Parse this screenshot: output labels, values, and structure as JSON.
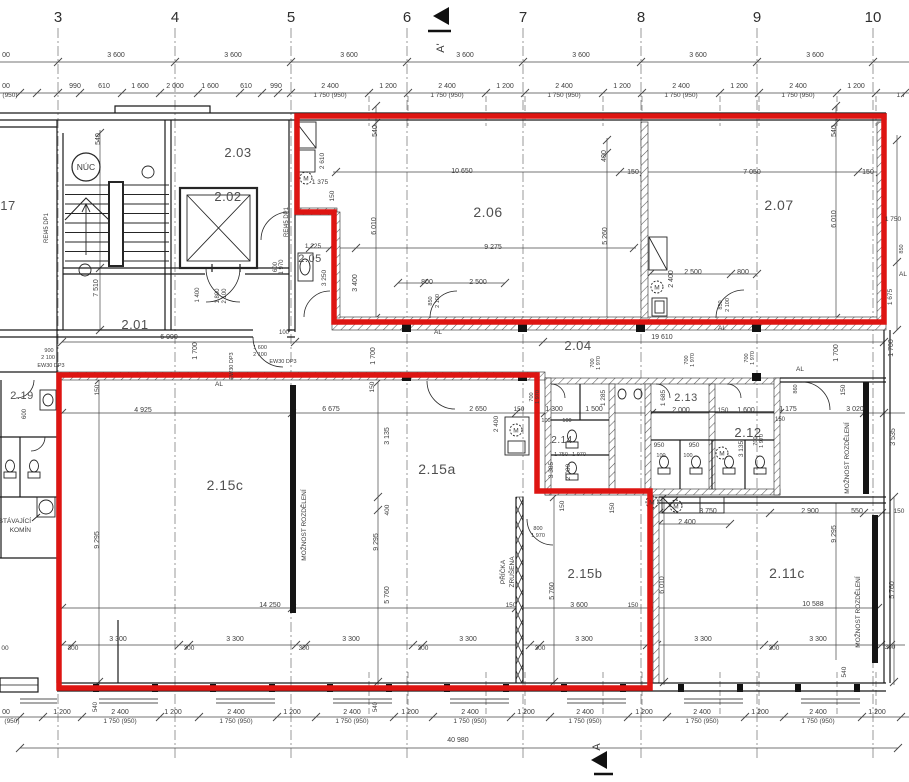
{
  "drawing": {
    "type": "floor-plan",
    "background": "#ffffff"
  },
  "colors": {
    "highlight_red": "#de1512",
    "ink": "#1b1b1b",
    "dim_text": "#3d3d3d"
  },
  "grid_numbers": [
    {
      "t": "3",
      "x": 58
    },
    {
      "t": "4",
      "x": 175
    },
    {
      "t": "5",
      "x": 291
    },
    {
      "t": "6",
      "x": 407
    },
    {
      "t": "7",
      "x": 523
    },
    {
      "t": "8",
      "x": 641
    },
    {
      "t": "9",
      "x": 757
    },
    {
      "t": "10",
      "x": 873
    }
  ],
  "section_markers": {
    "top": "A'",
    "bottom": "A"
  },
  "rooms": [
    {
      "t": "17",
      "x": 8,
      "y": 210,
      "s": 13
    },
    {
      "t": "2.01",
      "x": 135,
      "y": 329,
      "s": 13
    },
    {
      "t": "2.02",
      "x": 228,
      "y": 201,
      "s": 13
    },
    {
      "t": "2.03",
      "x": 238,
      "y": 157,
      "s": 13
    },
    {
      "t": "2.04",
      "x": 578,
      "y": 350,
      "s": 13
    },
    {
      "t": "2.05",
      "x": 310,
      "y": 262,
      "s": 11
    },
    {
      "t": "2.06",
      "x": 488,
      "y": 217,
      "s": 14
    },
    {
      "t": "2.07",
      "x": 779,
      "y": 210,
      "s": 14
    },
    {
      "t": "2.11c",
      "x": 787,
      "y": 578,
      "s": 14
    },
    {
      "t": "2.12",
      "x": 748,
      "y": 437,
      "s": 13
    },
    {
      "t": "2.13",
      "x": 686,
      "y": 401,
      "s": 11
    },
    {
      "t": "2.14",
      "x": 562,
      "y": 443,
      "s": 10
    },
    {
      "t": "2.15a",
      "x": 437,
      "y": 474,
      "s": 14
    },
    {
      "t": "2.15b",
      "x": 585,
      "y": 578,
      "s": 13
    },
    {
      "t": "2.15c",
      "x": 225,
      "y": 490,
      "s": 14
    },
    {
      "t": "2.19",
      "x": 22,
      "y": 399,
      "s": 11
    }
  ],
  "special_labels": {
    "nuc": {
      "t": "NÚC",
      "x": 86,
      "y": 167,
      "radius": 14
    },
    "motor_letter": "M",
    "motors": [
      {
        "x": 306,
        "y": 178
      },
      {
        "x": 657,
        "y": 287
      },
      {
        "x": 516,
        "y": 430
      },
      {
        "x": 652,
        "y": 502
      },
      {
        "x": 722,
        "y": 453
      },
      {
        "x": 676,
        "y": 506
      }
    ]
  },
  "annotations": [
    {
      "t": "STÁVAJÍCÍ",
      "x": 31,
      "y": 523,
      "s": 6.5,
      "a": "e"
    },
    {
      "t": "KOMÍN",
      "x": 31,
      "y": 532,
      "s": 6.5,
      "a": "e"
    },
    {
      "t": "MOŽNOST ROZDĚLENÍ",
      "x": 306,
      "y": 525,
      "r": 1,
      "s": 6.5
    },
    {
      "t": "MOŽNOST ROZDĚLENÍ",
      "x": 849,
      "y": 458,
      "r": 1,
      "s": 6.5
    },
    {
      "t": "MOŽNOST ROZDĚLENÍ",
      "x": 860,
      "y": 612,
      "r": 1,
      "s": 6.5
    },
    {
      "t": "PŘÍČKA",
      "x": 505,
      "y": 572,
      "r": 1,
      "s": 6.5
    },
    {
      "t": "ZRUŠENA",
      "x": 514,
      "y": 572,
      "r": 1,
      "s": 6.5
    },
    {
      "t": "AL",
      "x": 219,
      "y": 386,
      "s": 6.5
    },
    {
      "t": "AL",
      "x": 438,
      "y": 334,
      "s": 6.5
    },
    {
      "t": "AL",
      "x": 722,
      "y": 330,
      "s": 6.5
    },
    {
      "t": "AL",
      "x": 800,
      "y": 371,
      "s": 6.5
    },
    {
      "t": "AL",
      "x": 903,
      "y": 276,
      "s": 6.5
    },
    {
      "t": "EW30 DP3",
      "x": 51,
      "y": 367,
      "s": 5.5
    },
    {
      "t": "EW30 DP3",
      "x": 283,
      "y": 363,
      "s": 5.5
    },
    {
      "t": "EW30 DP3",
      "x": 233,
      "y": 366,
      "r": 1,
      "s": 5.5
    },
    {
      "t": "REI45 DP1",
      "x": 48,
      "y": 228,
      "r": 1,
      "s": 6
    },
    {
      "t": "REI45 DP1",
      "x": 288,
      "y": 222,
      "r": 1,
      "s": 6
    }
  ],
  "dimensions": [
    {
      "t": "00",
      "x": 6,
      "y": 57
    },
    {
      "t": "3 600",
      "x": 116,
      "y": 57
    },
    {
      "t": "3 600",
      "x": 233,
      "y": 57
    },
    {
      "t": "3 600",
      "x": 349,
      "y": 57
    },
    {
      "t": "3 600",
      "x": 465,
      "y": 57
    },
    {
      "t": "3 600",
      "x": 581,
      "y": 57
    },
    {
      "t": "3 600",
      "x": 698,
      "y": 57
    },
    {
      "t": "3 600",
      "x": 815,
      "y": 57
    },
    {
      "t": "00",
      "x": 6,
      "y": 88
    },
    {
      "t": "(950)",
      "x": 10,
      "y": 97,
      "s": 6.5
    },
    {
      "t": "990",
      "x": 75,
      "y": 88
    },
    {
      "t": "610",
      "x": 104,
      "y": 88
    },
    {
      "t": "1 600",
      "x": 140,
      "y": 88
    },
    {
      "t": "2 000",
      "x": 175,
      "y": 88
    },
    {
      "t": "1 600",
      "x": 210,
      "y": 88
    },
    {
      "t": "610",
      "x": 246,
      "y": 88
    },
    {
      "t": "990",
      "x": 276,
      "y": 88
    },
    {
      "t": "2 400",
      "x": 330,
      "y": 88
    },
    {
      "t": "1 750 (950)",
      "x": 330,
      "y": 97,
      "s": 6.5
    },
    {
      "t": "1 200",
      "x": 388,
      "y": 88
    },
    {
      "t": "2 400",
      "x": 447,
      "y": 88
    },
    {
      "t": "1 750 (950)",
      "x": 447,
      "y": 97,
      "s": 6.5
    },
    {
      "t": "1 200",
      "x": 505,
      "y": 88
    },
    {
      "t": "2 400",
      "x": 564,
      "y": 88
    },
    {
      "t": "1 750 (950)",
      "x": 564,
      "y": 97,
      "s": 6.5
    },
    {
      "t": "1 200",
      "x": 622,
      "y": 88
    },
    {
      "t": "2 400",
      "x": 681,
      "y": 88
    },
    {
      "t": "1 750 (950)",
      "x": 681,
      "y": 97,
      "s": 6.5
    },
    {
      "t": "1 200",
      "x": 739,
      "y": 88
    },
    {
      "t": "2 400",
      "x": 798,
      "y": 88
    },
    {
      "t": "1 750 (950)",
      "x": 798,
      "y": 97,
      "s": 6.5
    },
    {
      "t": "1 200",
      "x": 856,
      "y": 88
    },
    {
      "t": "1 7",
      "x": 901,
      "y": 97,
      "s": 6.5
    },
    {
      "t": "00",
      "x": 6,
      "y": 714
    },
    {
      "t": "(950)",
      "x": 12,
      "y": 723,
      "s": 6.5
    },
    {
      "t": "1 200",
      "x": 62,
      "y": 714
    },
    {
      "t": "540",
      "x": 97,
      "y": 707,
      "r": 1,
      "s": 6
    },
    {
      "t": "2 400",
      "x": 120,
      "y": 714
    },
    {
      "t": "1 750 (950)",
      "x": 120,
      "y": 723,
      "s": 6.5
    },
    {
      "t": "1 200",
      "x": 173,
      "y": 714
    },
    {
      "t": "2 400",
      "x": 236,
      "y": 714
    },
    {
      "t": "1 750 (950)",
      "x": 236,
      "y": 723,
      "s": 6.5
    },
    {
      "t": "1 200",
      "x": 292,
      "y": 714
    },
    {
      "t": "2 400",
      "x": 352,
      "y": 714
    },
    {
      "t": "1 750 (950)",
      "x": 352,
      "y": 723,
      "s": 6.5
    },
    {
      "t": "540",
      "x": 377,
      "y": 707,
      "r": 1,
      "s": 6
    },
    {
      "t": "1 200",
      "x": 410,
      "y": 714
    },
    {
      "t": "2 400",
      "x": 470,
      "y": 714
    },
    {
      "t": "1 750 (950)",
      "x": 470,
      "y": 723,
      "s": 6.5
    },
    {
      "t": "1 200",
      "x": 526,
      "y": 714
    },
    {
      "t": "2 400",
      "x": 585,
      "y": 714
    },
    {
      "t": "1 750 (950)",
      "x": 585,
      "y": 723,
      "s": 6.5
    },
    {
      "t": "1 200",
      "x": 644,
      "y": 714
    },
    {
      "t": "2 400",
      "x": 702,
      "y": 714
    },
    {
      "t": "1 750 (950)",
      "x": 702,
      "y": 723,
      "s": 6.5
    },
    {
      "t": "1 200",
      "x": 760,
      "y": 714
    },
    {
      "t": "2 400",
      "x": 818,
      "y": 714
    },
    {
      "t": "1 750 (950)",
      "x": 818,
      "y": 723,
      "s": 6.5
    },
    {
      "t": "1 200",
      "x": 877,
      "y": 714
    },
    {
      "t": "40 980",
      "x": 458,
      "y": 742
    },
    {
      "t": "540",
      "x": 100,
      "y": 139,
      "r": 1,
      "s": 7
    },
    {
      "t": "7 510",
      "x": 98,
      "y": 288,
      "r": 1
    },
    {
      "t": "1 400",
      "x": 199,
      "y": 295,
      "r": 1,
      "s": 6
    },
    {
      "t": "1 800",
      "x": 219,
      "y": 296,
      "r": 1,
      "s": 6
    },
    {
      "t": "2 100",
      "x": 226,
      "y": 296,
      "r": 1,
      "s": 6
    },
    {
      "t": "600",
      "x": 277,
      "y": 267,
      "r": 1,
      "s": 6
    },
    {
      "t": "1 970",
      "x": 283,
      "y": 267,
      "r": 1,
      "s": 6
    },
    {
      "t": "6 990",
      "x": 169,
      "y": 339
    },
    {
      "t": "100",
      "x": 284,
      "y": 334,
      "s": 6
    },
    {
      "t": "900",
      "x": 49,
      "y": 352,
      "s": 5.5
    },
    {
      "t": "2 100",
      "x": 48,
      "y": 359,
      "s": 5.5
    },
    {
      "t": "1 600",
      "x": 260,
      "y": 349,
      "s": 5.5
    },
    {
      "t": "2 100",
      "x": 260,
      "y": 356,
      "s": 5.5
    },
    {
      "t": "600",
      "x": 26,
      "y": 414,
      "r": 1,
      "s": 6
    },
    {
      "t": "2 610",
      "x": 324,
      "y": 161,
      "r": 1,
      "s": 6.5
    },
    {
      "t": "1 375",
      "x": 320,
      "y": 184,
      "s": 6.5
    },
    {
      "t": "150",
      "x": 334,
      "y": 196,
      "r": 1,
      "s": 6.5
    },
    {
      "t": "1 225",
      "x": 313,
      "y": 248,
      "s": 6.5
    },
    {
      "t": "3 250",
      "x": 326,
      "y": 278,
      "r": 1,
      "s": 6.5
    },
    {
      "t": "3 400",
      "x": 357,
      "y": 283,
      "r": 1
    },
    {
      "t": "540",
      "x": 377,
      "y": 131,
      "r": 1,
      "s": 7
    },
    {
      "t": "6 010",
      "x": 376,
      "y": 226,
      "r": 1
    },
    {
      "t": "10 650",
      "x": 462,
      "y": 173
    },
    {
      "t": "9 275",
      "x": 493,
      "y": 249
    },
    {
      "t": "800",
      "x": 427,
      "y": 284,
      "s": 7
    },
    {
      "t": "2 500",
      "x": 478,
      "y": 284
    },
    {
      "t": "850",
      "x": 432,
      "y": 301,
      "r": 1,
      "s": 5.5
    },
    {
      "t": "2 100",
      "x": 439,
      "y": 301,
      "r": 1,
      "s": 5.5
    },
    {
      "t": "400",
      "x": 606,
      "y": 156,
      "r": 1,
      "s": 7
    },
    {
      "t": "5 260",
      "x": 607,
      "y": 236,
      "r": 1
    },
    {
      "t": "150",
      "x": 633,
      "y": 174,
      "s": 7
    },
    {
      "t": "7 050",
      "x": 752,
      "y": 174
    },
    {
      "t": "150",
      "x": 868,
      "y": 174,
      "s": 7
    },
    {
      "t": "540",
      "x": 836,
      "y": 131,
      "r": 1,
      "s": 7
    },
    {
      "t": "6 010",
      "x": 836,
      "y": 219,
      "r": 1
    },
    {
      "t": "2 400",
      "x": 673,
      "y": 279,
      "r": 1
    },
    {
      "t": "2 500",
      "x": 693,
      "y": 274
    },
    {
      "t": "800",
      "x": 743,
      "y": 274,
      "s": 7
    },
    {
      "t": "850",
      "x": 722,
      "y": 305,
      "r": 1,
      "s": 5.5
    },
    {
      "t": "2 100",
      "x": 729,
      "y": 305,
      "r": 1,
      "s": 5.5
    },
    {
      "t": "1 750",
      "x": 893,
      "y": 221,
      "s": 6.5
    },
    {
      "t": "850",
      "x": 903,
      "y": 249,
      "r": 1,
      "s": 5.5
    },
    {
      "t": "1 675",
      "x": 892,
      "y": 297,
      "r": 1,
      "s": 6.5
    },
    {
      "t": "19 610",
      "x": 662,
      "y": 339
    },
    {
      "t": "1 700",
      "x": 197,
      "y": 351,
      "r": 1
    },
    {
      "t": "1 700",
      "x": 375,
      "y": 356,
      "r": 1
    },
    {
      "t": "1 700",
      "x": 838,
      "y": 353,
      "r": 1
    },
    {
      "t": "1 700",
      "x": 893,
      "y": 348,
      "r": 1
    },
    {
      "t": "150",
      "x": 99,
      "y": 390,
      "r": 1,
      "s": 6.5
    },
    {
      "t": "150",
      "x": 374,
      "y": 387,
      "r": 1,
      "s": 6.5
    },
    {
      "t": "150",
      "x": 845,
      "y": 390,
      "r": 1,
      "s": 6.5
    },
    {
      "t": "1 285",
      "x": 605,
      "y": 398,
      "r": 1,
      "s": 6.5
    },
    {
      "t": "1 300",
      "x": 554,
      "y": 411,
      "s": 7
    },
    {
      "t": "1 500",
      "x": 594,
      "y": 411,
      "s": 7
    },
    {
      "t": "100",
      "x": 546,
      "y": 422,
      "s": 5.5
    },
    {
      "t": "100",
      "x": 567,
      "y": 422,
      "s": 5.5
    },
    {
      "t": "700",
      "x": 533,
      "y": 397,
      "r": 1,
      "s": 5.5
    },
    {
      "t": "1 970",
      "x": 539,
      "y": 397,
      "r": 1,
      "s": 5.5
    },
    {
      "t": "700",
      "x": 594,
      "y": 363,
      "r": 1,
      "s": 5.5
    },
    {
      "t": "1 970",
      "x": 600,
      "y": 363,
      "r": 1,
      "s": 5.5
    },
    {
      "t": "700",
      "x": 688,
      "y": 360,
      "r": 1,
      "s": 5.5
    },
    {
      "t": "1 970",
      "x": 694,
      "y": 360,
      "r": 1,
      "s": 5.5
    },
    {
      "t": "700",
      "x": 748,
      "y": 358,
      "r": 1,
      "s": 5.5
    },
    {
      "t": "1 970",
      "x": 754,
      "y": 358,
      "r": 1,
      "s": 5.5
    },
    {
      "t": "1 750",
      "x": 561,
      "y": 456,
      "s": 5.5
    },
    {
      "t": "1 970",
      "x": 579,
      "y": 456,
      "s": 5.5
    },
    {
      "t": "3 385",
      "x": 553,
      "y": 470,
      "r": 1,
      "s": 6.5
    },
    {
      "t": "2 000",
      "x": 570,
      "y": 472,
      "r": 1,
      "s": 6.5
    },
    {
      "t": "1 685",
      "x": 665,
      "y": 398,
      "r": 1,
      "s": 6.5
    },
    {
      "t": "2 000",
      "x": 681,
      "y": 412,
      "s": 7
    },
    {
      "t": "150",
      "x": 723,
      "y": 412,
      "s": 6.5
    },
    {
      "t": "1 600",
      "x": 746,
      "y": 412,
      "s": 7
    },
    {
      "t": "1 175",
      "x": 788,
      "y": 411,
      "s": 7
    },
    {
      "t": "150",
      "x": 780,
      "y": 421,
      "s": 6
    },
    {
      "t": "3 020",
      "x": 855,
      "y": 411
    },
    {
      "t": "950",
      "x": 659,
      "y": 447,
      "s": 6.5
    },
    {
      "t": "950",
      "x": 694,
      "y": 447,
      "s": 6.5
    },
    {
      "t": "100",
      "x": 661,
      "y": 457,
      "s": 5.5
    },
    {
      "t": "100",
      "x": 688,
      "y": 457,
      "s": 5.5
    },
    {
      "t": "3 135",
      "x": 743,
      "y": 449,
      "r": 1,
      "s": 6.5
    },
    {
      "t": "860",
      "x": 797,
      "y": 389,
      "r": 1,
      "s": 5.5
    },
    {
      "t": "3 535",
      "x": 895,
      "y": 437,
      "r": 1
    },
    {
      "t": "700",
      "x": 757,
      "y": 441,
      "r": 1,
      "s": 5.5
    },
    {
      "t": "1 970",
      "x": 763,
      "y": 441,
      "r": 1,
      "s": 5.5
    },
    {
      "t": "4 925",
      "x": 143,
      "y": 412
    },
    {
      "t": "6 675",
      "x": 331,
      "y": 411
    },
    {
      "t": "2 650",
      "x": 478,
      "y": 411
    },
    {
      "t": "150",
      "x": 519,
      "y": 411,
      "s": 6.5
    },
    {
      "t": "2 400",
      "x": 498,
      "y": 424,
      "r": 1,
      "s": 6.5
    },
    {
      "t": "3 135",
      "x": 389,
      "y": 436,
      "r": 1
    },
    {
      "t": "9 295",
      "x": 99,
      "y": 540,
      "r": 1
    },
    {
      "t": "9 295",
      "x": 378,
      "y": 542,
      "r": 1
    },
    {
      "t": "400",
      "x": 389,
      "y": 510,
      "r": 1,
      "s": 6.5
    },
    {
      "t": "5 760",
      "x": 389,
      "y": 595,
      "r": 1
    },
    {
      "t": "14 250",
      "x": 270,
      "y": 607
    },
    {
      "t": "800",
      "x": 538,
      "y": 530,
      "s": 5.5
    },
    {
      "t": "1 970",
      "x": 538,
      "y": 537,
      "s": 5.5
    },
    {
      "t": "150",
      "x": 564,
      "y": 506,
      "r": 1,
      "s": 6.5
    },
    {
      "t": "150",
      "x": 614,
      "y": 508,
      "r": 1,
      "s": 6.5
    },
    {
      "t": "5 760",
      "x": 554,
      "y": 591,
      "r": 1
    },
    {
      "t": "150",
      "x": 511,
      "y": 607,
      "s": 6.5
    },
    {
      "t": "3 600",
      "x": 579,
      "y": 607
    },
    {
      "t": "150",
      "x": 633,
      "y": 607,
      "s": 6.5
    },
    {
      "t": "3 300",
      "x": 118,
      "y": 641
    },
    {
      "t": "3 300",
      "x": 235,
      "y": 641
    },
    {
      "t": "3 300",
      "x": 351,
      "y": 641
    },
    {
      "t": "3 300",
      "x": 468,
      "y": 641
    },
    {
      "t": "3 300",
      "x": 584,
      "y": 641
    },
    {
      "t": "3 300",
      "x": 703,
      "y": 641
    },
    {
      "t": "3 300",
      "x": 818,
      "y": 641
    },
    {
      "t": "00",
      "x": 5,
      "y": 650,
      "s": 6.5
    },
    {
      "t": "300",
      "x": 73,
      "y": 650,
      "s": 6.5
    },
    {
      "t": "300",
      "x": 189,
      "y": 650,
      "s": 6.5
    },
    {
      "t": "300",
      "x": 304,
      "y": 650,
      "s": 6.5
    },
    {
      "t": "300",
      "x": 423,
      "y": 650,
      "s": 6.5
    },
    {
      "t": "300",
      "x": 540,
      "y": 650,
      "s": 6.5
    },
    {
      "t": "300",
      "x": 774,
      "y": 650,
      "s": 6.5
    },
    {
      "t": "300",
      "x": 890,
      "y": 649,
      "s": 6.5
    },
    {
      "t": "3 750",
      "x": 708,
      "y": 513
    },
    {
      "t": "2 400",
      "x": 687,
      "y": 524
    },
    {
      "t": "2 900",
      "x": 810,
      "y": 513
    },
    {
      "t": "550",
      "x": 857,
      "y": 513,
      "s": 7
    },
    {
      "t": "150",
      "x": 899,
      "y": 513,
      "s": 6.5
    },
    {
      "t": "9 295",
      "x": 836,
      "y": 534,
      "r": 1
    },
    {
      "t": "6 010",
      "x": 664,
      "y": 585,
      "r": 1
    },
    {
      "t": "10 588",
      "x": 813,
      "y": 606
    },
    {
      "t": "5 760",
      "x": 894,
      "y": 590,
      "r": 1
    },
    {
      "t": "540",
      "x": 846,
      "y": 672,
      "r": 1,
      "s": 6.5
    }
  ]
}
